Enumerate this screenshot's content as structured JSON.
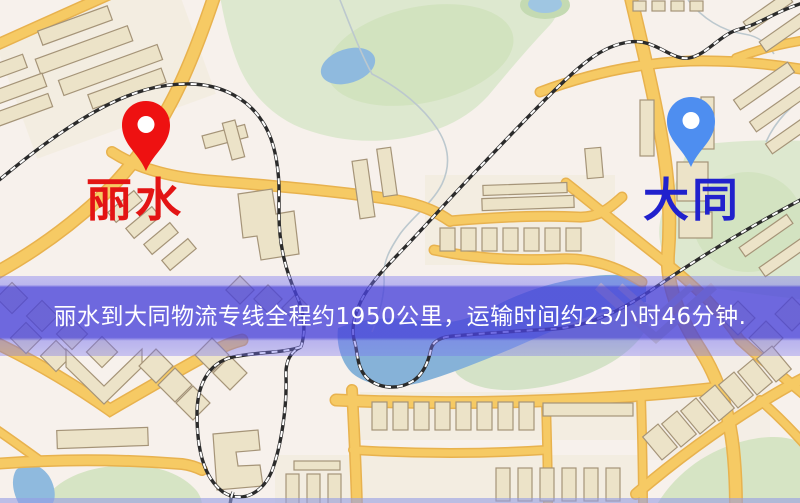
{
  "banner": {
    "text": "丽水到大同物流专线全程约1950公里，运输时间约23小时46分钟.",
    "text_color": "#ffffff",
    "overlay_color": "#4842da"
  },
  "route": {
    "origin": "丽水",
    "destination": "大同",
    "distance_text": "约1950公里",
    "duration_text": "约23小时46分钟"
  },
  "markers": {
    "origin": {
      "label": "丽水",
      "label_color": "#e31414",
      "pin_color": "#ee1111"
    },
    "destination": {
      "label": "大同",
      "label_color": "#2121cd",
      "pin_color": "#4e8ef0"
    }
  },
  "map_theme": {
    "background": "#f7f1ec",
    "road_fill": "#f6ca64",
    "road_casing": "#e8b24e",
    "railway": "#2b2b2b",
    "park": "#dde8cf",
    "water": "#8fbade",
    "building": "#ece3c8",
    "building_outline": "#a59478"
  }
}
